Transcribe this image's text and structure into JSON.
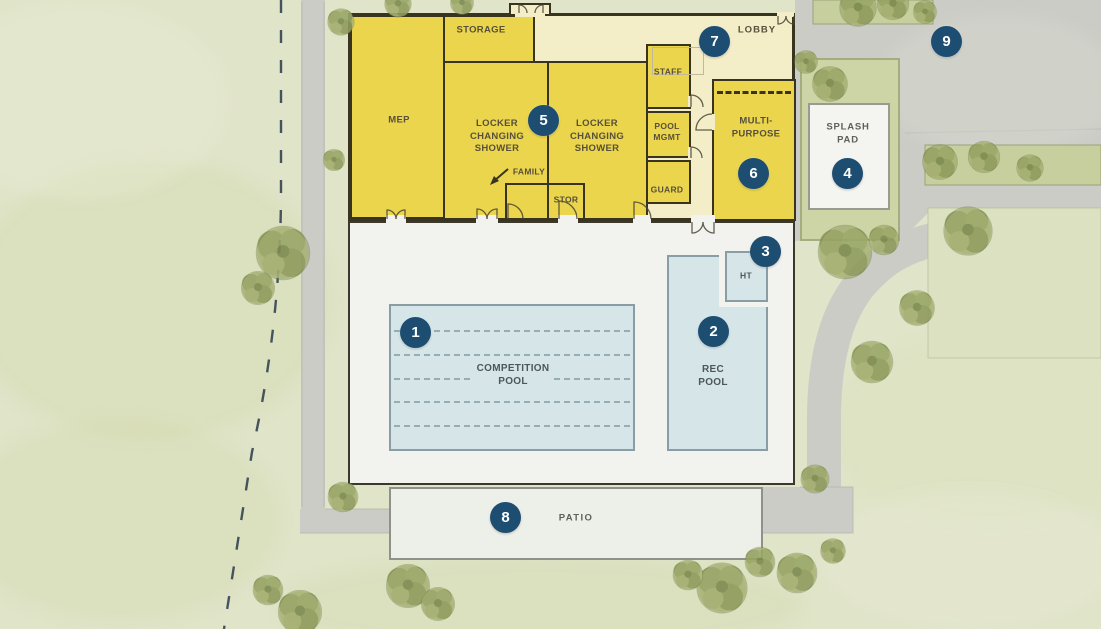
{
  "plan_type": "aquatic-center-site-plan",
  "rooms": {
    "mep": "MEP",
    "storage": "STORAGE",
    "locker_left": "LOCKER\nCHANGING\nSHOWER",
    "locker_right": "LOCKER\nCHANGING\nSHOWER",
    "family": "FAMILY",
    "stor": "STOR",
    "staff": "STAFF",
    "pool_mgmt": "POOL\nMGMT",
    "guard": "GUARD",
    "multi_purpose": "MULTI-\nPURPOSE",
    "lobby": "LOBBY"
  },
  "site": {
    "competition_pool": "COMPETITION\nPOOL",
    "rec_pool": "REC\nPOOL",
    "hot_tub": "HT",
    "splash_pad": "SPLASH\nPAD",
    "patio": "PATIO"
  },
  "markers": [
    "1",
    "2",
    "3",
    "4",
    "5",
    "6",
    "7",
    "8",
    "9"
  ],
  "palette": {
    "marker_navy": "#1d4e72",
    "room_yellow": "#ebd54c",
    "lobby_pale_yellow": "#f3edc8",
    "wall_dark": "#38341f",
    "pool_water_blue": "#d6e6e8",
    "deck_white": "#f2f2ee",
    "pavement_gray": "#cbccc5",
    "grass_green": "#e0e4c8",
    "tree_green": "#a9b377"
  }
}
